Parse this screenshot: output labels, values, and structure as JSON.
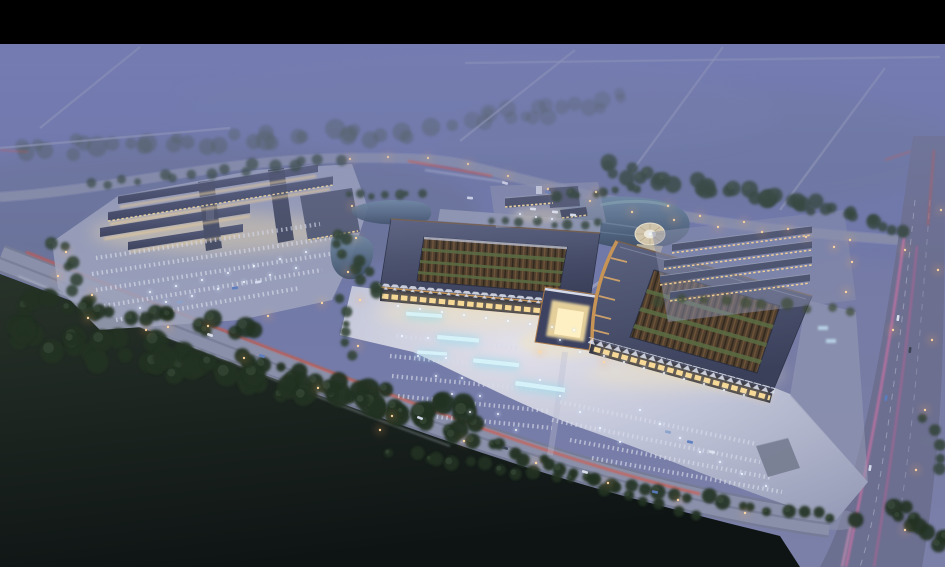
{
  "scene": {
    "description": "Dusk aerial rendering of a large market/exhibition campus: two bronze-trimmed courtyard halls with a central gate and illuminated plaza, a smaller lit building complex with parking to the west, a pond with circular fountain plaza, rows of low buildings to the east, foggy purple farmland behind, dark forest in front, and roads with light trails.",
    "letterbox_top_height": 44,
    "palette": {
      "letterbox": "#000000",
      "skyTop": "#6d75ac",
      "skyMid": "#7179a8",
      "skyLow": "#7b80a8",
      "haze": "#7b82b6",
      "fieldDarkTop": "#28332a",
      "fieldDarkBottom": "#0e1414",
      "roadFill": "#8b91aa",
      "roadEdge": "#767c96",
      "roadBack": "#878da8",
      "roadVertical": "#6b6f8e",
      "laneDash": "#c9cede",
      "tailRed": "#e1503a",
      "headWhite": "#dde3f2",
      "pink1": "#e873ab",
      "pink2": "#d25f96",
      "lamp": "#ffab5e",
      "lampCore": "#ffd9a0",
      "light": "#ffffff",
      "lightHalo": "#cfe0ff",
      "plazaBright": "#e6e4ec",
      "plazaMid": "#c3c7da",
      "plazaFar": "#979db8",
      "padGrey": "#9fa5bd",
      "roofLight": "#5c6380",
      "roofDark": "#3a405a",
      "roofRow": "#4e5570",
      "ridge": "#9aa2b8",
      "bronze": "#a9794a",
      "bronzeBright": "#c79455",
      "ribLit": "#d9a86a",
      "facadeShadow": "#262b3e",
      "windowWarm": "#ffe3a0",
      "glowWarm": "#ffd98e",
      "zigzag": "#d9dde9",
      "courtBase": "#503f2e",
      "courtDark": "#33291d",
      "courtRib": "#6f5438",
      "courtGreen": "#5a6a42",
      "waterTop": "#6f89a2",
      "waterBottom": "#3e4f68",
      "circleTan": "#d6c9ab",
      "circleInner": "#f4eeda",
      "stall": "#d8dcea",
      "teal": "#8fdcec",
      "tealCore": "#dbf6fb",
      "treeDark": "#233022",
      "treeMid": "#2d4030",
      "treeFog": "#46544c",
      "treeGreen": "#3c4c34",
      "kiosk": "#bcd8ea"
    },
    "fog_roads": [
      [
        460,
        141,
        575,
        50
      ],
      [
        630,
        174,
        723,
        47
      ],
      [
        780,
        210,
        885,
        68
      ],
      [
        40,
        128,
        140,
        47
      ],
      [
        0,
        148,
        230,
        128
      ],
      [
        465,
        63,
        940,
        57
      ]
    ],
    "tree_belts": [
      [
        470,
        120,
        620,
        100,
        18,
        7,
        14,
        "treeFog",
        0.35
      ],
      [
        10,
        150,
        440,
        130,
        34,
        8,
        14,
        "treeFog",
        0.45
      ],
      [
        95,
        185,
        340,
        158,
        16,
        5,
        7,
        "treeMid",
        0.7
      ],
      [
        605,
        168,
        795,
        205,
        26,
        7,
        12,
        "treeMid",
        0.85
      ],
      [
        790,
        200,
        905,
        228,
        14,
        6,
        9,
        "treeMid",
        0.8
      ],
      [
        558,
        196,
        640,
        188,
        8,
        4.5,
        5,
        "treeMid",
        0.9
      ],
      [
        334,
        232,
        378,
        292,
        10,
        5,
        8,
        "treeMid",
        0.9
      ],
      [
        58,
        240,
        92,
        316,
        9,
        5,
        8,
        "treeMid",
        0.85
      ],
      [
        10,
        330,
        470,
        420,
        60,
        10,
        26,
        "treeDark",
        0.95
      ],
      [
        30,
        300,
        250,
        330,
        20,
        8,
        14,
        "treeDark",
        0.9
      ],
      [
        240,
        355,
        690,
        515,
        34,
        6.5,
        8,
        "treeDark",
        0.95
      ],
      [
        395,
        452,
        850,
        520,
        30,
        6,
        7,
        "treeDark",
        0.9
      ],
      [
        895,
        505,
        945,
        545,
        10,
        7,
        9,
        "treeDark",
        0.9
      ],
      [
        928,
        420,
        945,
        470,
        5,
        5,
        6,
        "treeMid",
        0.8
      ],
      [
        660,
        300,
        850,
        310,
        10,
        5,
        6,
        "treeGreen",
        0.7
      ],
      [
        488,
        222,
        600,
        224,
        8,
        4,
        4,
        "treeMid",
        0.8
      ],
      [
        350,
        196,
        420,
        192,
        7,
        4,
        4,
        "treeMid",
        0.85
      ],
      [
        340,
        300,
        352,
        356,
        6,
        4.5,
        5,
        "treeMid",
        0.85
      ]
    ],
    "parking_rows": [
      [
        96,
        258,
        320,
        224
      ],
      [
        92,
        274,
        330,
        238
      ],
      [
        96,
        290,
        330,
        254
      ],
      [
        104,
        306,
        322,
        270
      ],
      [
        116,
        320,
        300,
        288
      ],
      [
        396,
        336,
        520,
        348
      ],
      [
        390,
        356,
        530,
        369
      ],
      [
        392,
        376,
        540,
        390
      ],
      [
        398,
        396,
        548,
        411
      ],
      [
        408,
        414,
        552,
        428
      ],
      [
        560,
        402,
        756,
        444
      ],
      [
        552,
        420,
        760,
        462
      ],
      [
        570,
        440,
        772,
        478
      ],
      [
        592,
        458,
        782,
        492
      ]
    ],
    "fountains": [
      [
        424,
        316,
        36,
        9,
        4
      ],
      [
        458,
        340,
        42,
        10,
        5
      ],
      [
        496,
        364,
        46,
        10,
        6
      ],
      [
        540,
        388,
        50,
        11,
        8
      ],
      [
        432,
        354,
        30,
        8,
        4
      ]
    ],
    "kiosks": [
      [
        818,
        326
      ],
      [
        826,
        339
      ]
    ],
    "lamps": [
      [
        350,
        159
      ],
      [
        388,
        157
      ],
      [
        428,
        158
      ],
      [
        468,
        164
      ],
      [
        508,
        176
      ],
      [
        548,
        189
      ],
      [
        590,
        201
      ],
      [
        632,
        212
      ],
      [
        674,
        220
      ],
      [
        718,
        227
      ],
      [
        762,
        232
      ],
      [
        806,
        237
      ],
      [
        850,
        240
      ],
      [
        92,
        295
      ],
      [
        168,
        327
      ],
      [
        244,
        358
      ],
      [
        318,
        388
      ],
      [
        392,
        416
      ],
      [
        464,
        441
      ],
      [
        536,
        463
      ],
      [
        608,
        483
      ],
      [
        678,
        500
      ],
      [
        745,
        513
      ],
      [
        66,
        252
      ],
      [
        58,
        276
      ],
      [
        88,
        318
      ],
      [
        146,
        330
      ],
      [
        208,
        326
      ],
      [
        268,
        316
      ],
      [
        322,
        303
      ],
      [
        348,
        272
      ],
      [
        356,
        238
      ],
      [
        352,
        206
      ],
      [
        596,
        192
      ],
      [
        668,
        206
      ],
      [
        700,
        216
      ],
      [
        744,
        222
      ],
      [
        788,
        229
      ],
      [
        834,
        247
      ],
      [
        852,
        262
      ],
      [
        846,
        292
      ],
      [
        360,
        300
      ],
      [
        358,
        346
      ],
      [
        380,
        430
      ],
      [
        540,
        352
      ],
      [
        604,
        362
      ],
      [
        941,
        210
      ],
      [
        938,
        270
      ],
      [
        932,
        340
      ],
      [
        925,
        410
      ],
      [
        916,
        470
      ],
      [
        905,
        530
      ],
      [
        905,
        250
      ],
      [
        893,
        330
      ]
    ],
    "plaza_lights": [
      [
        398,
        306
      ],
      [
        420,
        309
      ],
      [
        442,
        312
      ],
      [
        464,
        315
      ],
      [
        486,
        318
      ],
      [
        508,
        321
      ],
      [
        530,
        324
      ],
      [
        552,
        327
      ],
      [
        574,
        330
      ],
      [
        604,
        356
      ],
      [
        624,
        362
      ],
      [
        644,
        368
      ],
      [
        664,
        373
      ],
      [
        684,
        379
      ],
      [
        704,
        384
      ],
      [
        724,
        390
      ],
      [
        744,
        395
      ],
      [
        402,
        336
      ],
      [
        418,
        356
      ],
      [
        436,
        376
      ],
      [
        452,
        394
      ],
      [
        470,
        412
      ],
      [
        428,
        338
      ],
      [
        446,
        358
      ],
      [
        462,
        378
      ],
      [
        480,
        396
      ],
      [
        498,
        414
      ],
      [
        516,
        430
      ],
      [
        540,
        380
      ],
      [
        560,
        396
      ],
      [
        580,
        412
      ],
      [
        600,
        428
      ],
      [
        620,
        442
      ],
      [
        560,
        340
      ],
      [
        580,
        352
      ],
      [
        640,
        410
      ],
      [
        660,
        424
      ],
      [
        680,
        438
      ],
      [
        700,
        452
      ],
      [
        720,
        462
      ],
      [
        742,
        474
      ],
      [
        766,
        486
      ],
      [
        150,
        292
      ],
      [
        176,
        286
      ],
      [
        202,
        280
      ],
      [
        228,
        273
      ],
      [
        254,
        266
      ],
      [
        280,
        259
      ],
      [
        306,
        252
      ],
      [
        140,
        308
      ],
      [
        166,
        302
      ],
      [
        192,
        296
      ],
      [
        218,
        289
      ],
      [
        244,
        282
      ],
      [
        270,
        275
      ],
      [
        296,
        268
      ],
      [
        520,
        214
      ],
      [
        536,
        217
      ],
      [
        552,
        219
      ],
      [
        650,
        234
      ]
    ],
    "cars": [
      [
        210,
        335,
        20,
        "#dfe4f0"
      ],
      [
        262,
        356,
        20,
        "#5b7cc0"
      ],
      [
        420,
        418,
        21,
        "#d8def0"
      ],
      [
        505,
        448,
        19,
        "#3a4250"
      ],
      [
        585,
        472,
        17,
        "#dfe4f0"
      ],
      [
        655,
        492,
        14,
        "#5b7cc0"
      ],
      [
        505,
        183,
        16,
        "#d8def0"
      ],
      [
        548,
        192,
        16,
        "#5b7cc0"
      ],
      [
        898,
        318,
        -82,
        "#dfe4f0"
      ],
      [
        886,
        398,
        -81,
        "#5b7cc0"
      ],
      [
        870,
        468,
        -80,
        "#d8def0"
      ],
      [
        910,
        350,
        -82,
        "#3a4250"
      ],
      [
        235,
        288,
        -9,
        "#5b7cc0"
      ],
      [
        258,
        282,
        -9,
        "#d8def0"
      ],
      [
        180,
        302,
        -9,
        "#8aa2cc"
      ],
      [
        690,
        442,
        12,
        "#5b7cc0"
      ],
      [
        712,
        452,
        12,
        "#dfe4f0"
      ],
      [
        668,
        432,
        12,
        "#8aa2cc"
      ],
      [
        470,
        198,
        5,
        "#d8def0"
      ],
      [
        555,
        212,
        4,
        "#e8ecf4"
      ],
      [
        573,
        215,
        4,
        "#e8ecf4"
      ],
      [
        533,
        209,
        4,
        "#e8ecf4"
      ]
    ]
  }
}
